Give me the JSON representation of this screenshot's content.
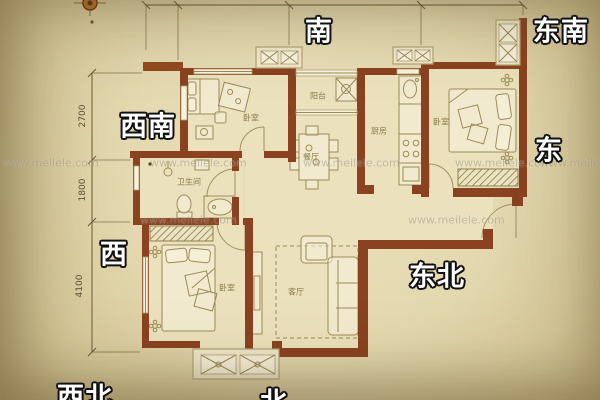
{
  "directions": {
    "south": "南",
    "southeast": "东南",
    "east": "东",
    "northeast": "东北",
    "north": "北",
    "northwest": "西北",
    "west": "西",
    "southwest": "西南"
  },
  "rooms": {
    "bedroom_top_left": "卧室",
    "balcony": "阳台",
    "kitchen": "厨房",
    "bedroom_right": "卧室",
    "dining": "餐厅",
    "bathroom": "卫生间",
    "living": "客厅",
    "master_bedroom": "卧室"
  },
  "dimensions": {
    "v1": "2700",
    "v2": "1800",
    "v3": "4100"
  },
  "watermark": "www.meilele.com",
  "colors": {
    "wall": "#8a4220",
    "paper": "#e3d8af",
    "floor": "#ebe1bc"
  }
}
